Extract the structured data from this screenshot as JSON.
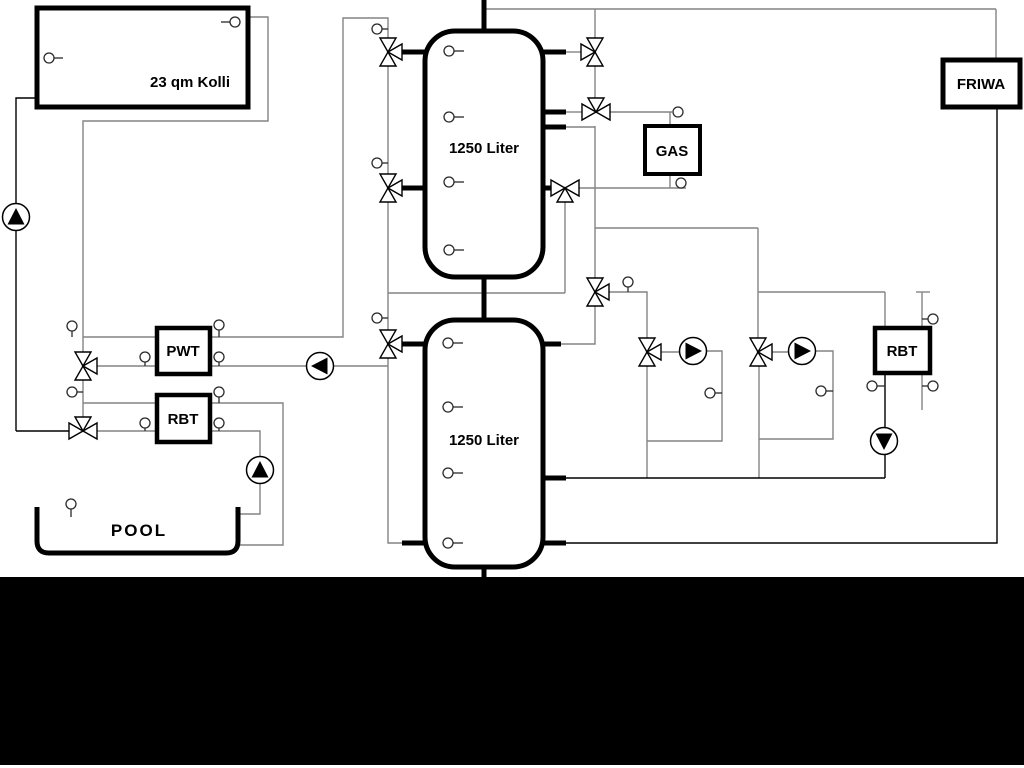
{
  "diagram": {
    "collector_label": "23 qm Kolli",
    "tank1_label": "1250 Liter",
    "tank2_label": "1250 Liter",
    "gas_label": "GAS",
    "friwa_label": "FRIWA",
    "pwt_label": "PWT",
    "rbt_left_label": "RBT",
    "rbt_right_label": "RBT",
    "pool_label": "POOL",
    "colors": {
      "background": "#ffffff",
      "line_gray": "#848484",
      "line_black": "#000000",
      "component_fill": "#ffffff",
      "footer_bar": "#000000"
    }
  }
}
